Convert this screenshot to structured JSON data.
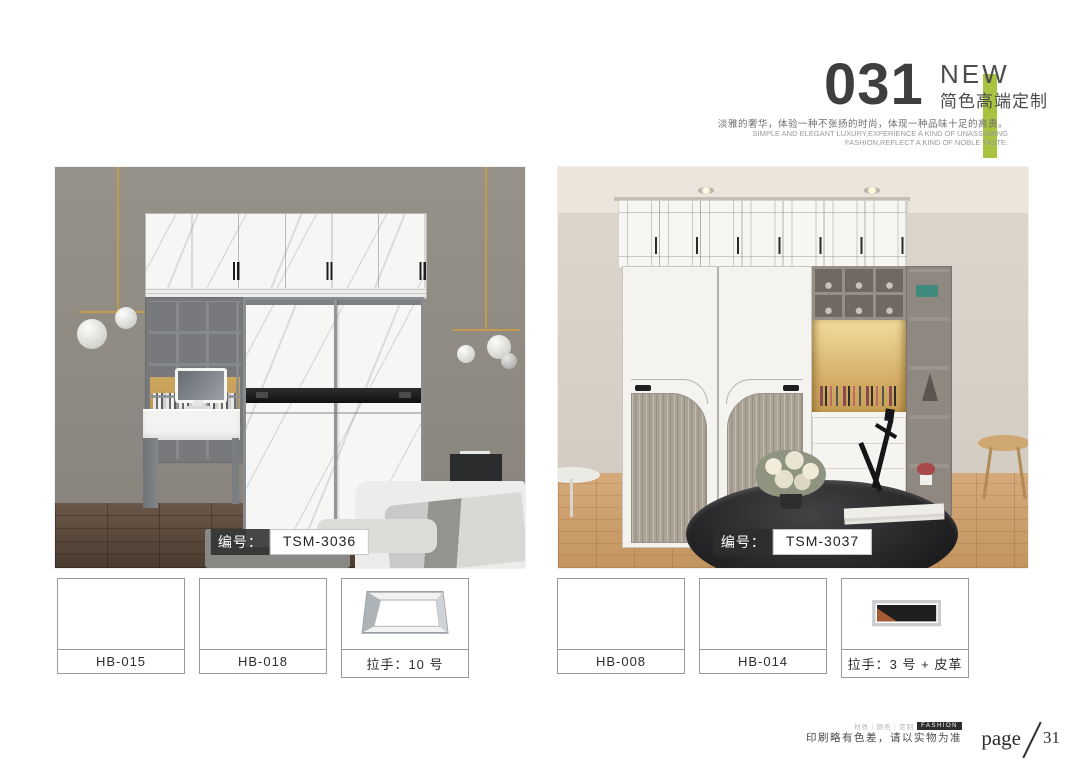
{
  "header": {
    "number": "031",
    "badge": "NEW",
    "series_title": "简色高端定制",
    "subtitle_cn": "淡雅的奢华，体验一种不张扬的时尚，体现一种品味十足的高贵。",
    "subtitle_en": "SIMPLE AND ELEGANT LUXURY,EXPERIENCE A KIND OF UNASSUMING FASHION,REFLECT A KIND OF NOBLE TASTE.",
    "accent_color": "#a9c23f"
  },
  "photos": [
    {
      "caption_prefix": "编号：",
      "code": "TSM-3036"
    },
    {
      "caption_prefix": "编号：",
      "code": "TSM-3037"
    }
  ],
  "swatches": {
    "left": [
      {
        "label": "HB-015"
      },
      {
        "label": "HB-018"
      },
      {
        "label": "拉手：10 号"
      }
    ],
    "right": [
      {
        "label": "HB-008"
      },
      {
        "label": "HB-014"
      },
      {
        "label": "拉手：3 号 + 皮革"
      }
    ]
  },
  "footer": {
    "brand_line": "材质｜颜色｜定制",
    "brand_badge": "FASHION",
    "disclaimer": "印刷略有色差，请以实物为准",
    "page_label": "page",
    "page_number": "31"
  }
}
